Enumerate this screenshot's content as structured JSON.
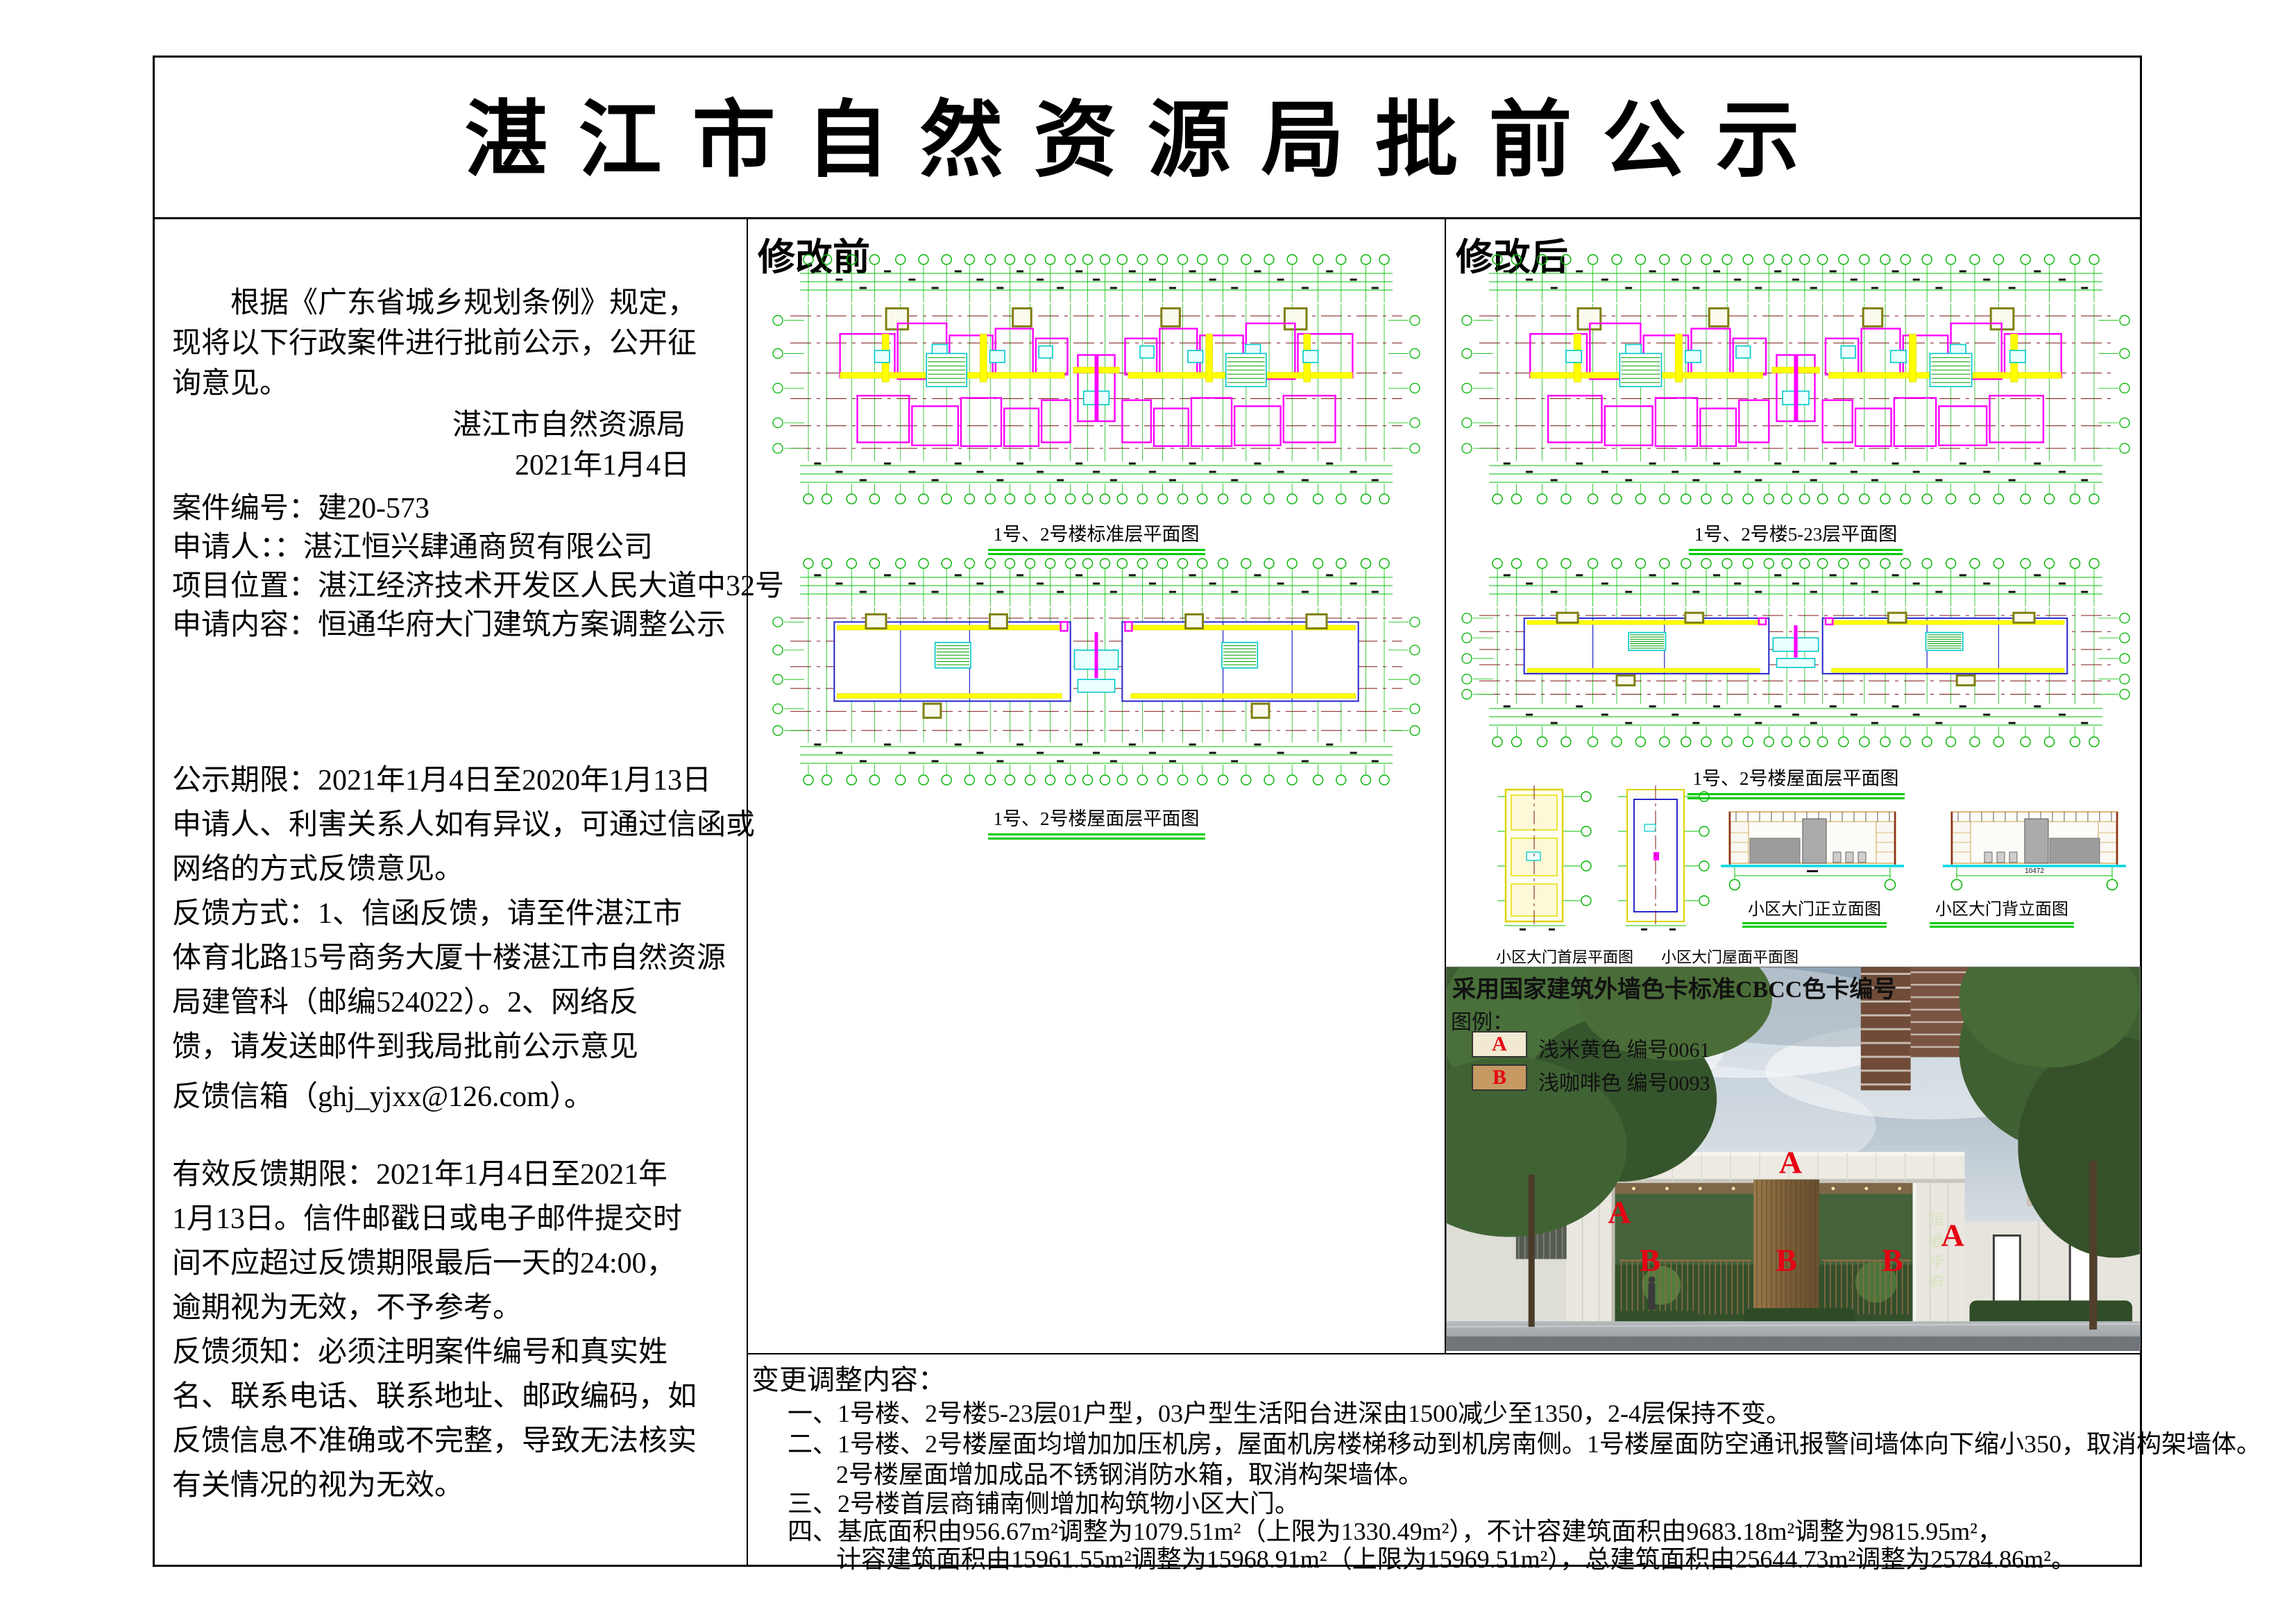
{
  "title": "湛江市自然资源局批前公示",
  "left_panel": {
    "intro_lines": [
      "　　根据《广东省城乡规划条例》规定，",
      "现将以下行政案件进行批前公示，公开征",
      "询意见。"
    ],
    "agency": "湛江市自然资源局",
    "date": "2021年1月4日",
    "case_lines": [
      "案件编号：建20-573",
      "申请人：：湛江恒兴肆通商贸有限公司",
      "项目位置：湛江经济技术开发区人民大道中32号",
      "申请内容：恒通华府大门建筑方案调整公示"
    ],
    "notice_lines": [
      "公示期限：2021年1月4日至2020年1月13日",
      "申请人、利害关系人如有异议，可通过信函或",
      "网络的方式反馈意见。",
      "反馈方式：1、信函反馈，请至件湛江市",
      "体育北路15号商务大厦十楼湛江市自然资源",
      "局建管科（邮编524022）。2、网络反",
      "馈，请发送邮件到我局批前公示意见",
      "反馈信箱（ghj_yjxx@126.com）。"
    ],
    "feedback_lines": [
      "有效反馈期限：2021年1月4日至2021年",
      " 1月13日。信件邮戳日或电子邮件提交时",
      "间不应超过反馈期限最后一天的24:00，",
      "逾期视为无效，不予参考。",
      "反馈须知：必须注明案件编号和真实姓",
      "名、联系电话、联系地址、邮政编码，如",
      "反馈信息不准确或不完整，导致无法核实",
      "有关情况的视为无效。"
    ]
  },
  "before_panel": {
    "label": "修改前",
    "fig1_caption": "1号、2号楼标准层平面图",
    "fig2_caption": "1号、2号楼屋面层平面图"
  },
  "after_panel": {
    "label": "修改后",
    "fig1_caption": "1号、2号楼5-23层平面图",
    "fig2_caption": "1号、2号楼屋面层平面图",
    "gate_plan_captions": [
      "小区大门首层平面图",
      "小区大门屋面平面图"
    ],
    "gate_elev_captions": [
      "小区大门正立面图",
      "小区大门背立面图"
    ],
    "gate_elev_dim": "10472"
  },
  "color_card": {
    "heading": "采用国家建筑外墙色卡标准CBCC色卡编号",
    "legend_label": "图例：",
    "entries": [
      {
        "key": "A",
        "name": "浅米黄色",
        "code": "编号0061",
        "swatch": "#f1e9d2"
      },
      {
        "key": "B",
        "name": "浅咖啡色",
        "code": "编号0093",
        "swatch": "#c49a62"
      }
    ],
    "gate_sign": "恒通华府",
    "annotations": [
      {
        "label": "A",
        "x": 49.6,
        "y": 50.9
      },
      {
        "label": "A",
        "x": 24.9,
        "y": 63.9
      },
      {
        "label": "A",
        "x": 73.0,
        "y": 69.9
      },
      {
        "label": "B",
        "x": 29.3,
        "y": 76.4
      },
      {
        "label": "B",
        "x": 49.0,
        "y": 76.4
      },
      {
        "label": "B",
        "x": 64.3,
        "y": 76.4
      }
    ]
  },
  "changes": {
    "heading": "变更调整内容：",
    "lines": [
      {
        "text": "一、1号楼、2号楼5-23层01户型，03户型生活阳台进深由1500减少至1350，2-4层保持不变。",
        "indent": 1
      },
      {
        "text": "二、1号楼、2号楼屋面均增加加压机房，屋面机房楼梯移动到机房南侧。1号楼屋面防空通讯报警间墙体向下缩小350，取消构架墙体。",
        "indent": 1
      },
      {
        "text": "2号楼屋面增加成品不锈钢消防水箱，取消构架墙体。",
        "indent": 2
      },
      {
        "text": "三、2号楼首层商铺南侧增加构筑物小区大门。",
        "indent": 1
      },
      {
        "text": "四、基底面积由956.67m²调整为1079.51m²（上限为1330.49m²），不计容建筑面积由9683.18m²调整为9815.95m²，",
        "indent": 1
      },
      {
        "text": "计容建筑面积由15961.55m²调整为15968.91m²（上限为15969.51m²），总建筑面积由25644.73m²调整为25784.86m²。",
        "indent": 2
      }
    ]
  }
}
